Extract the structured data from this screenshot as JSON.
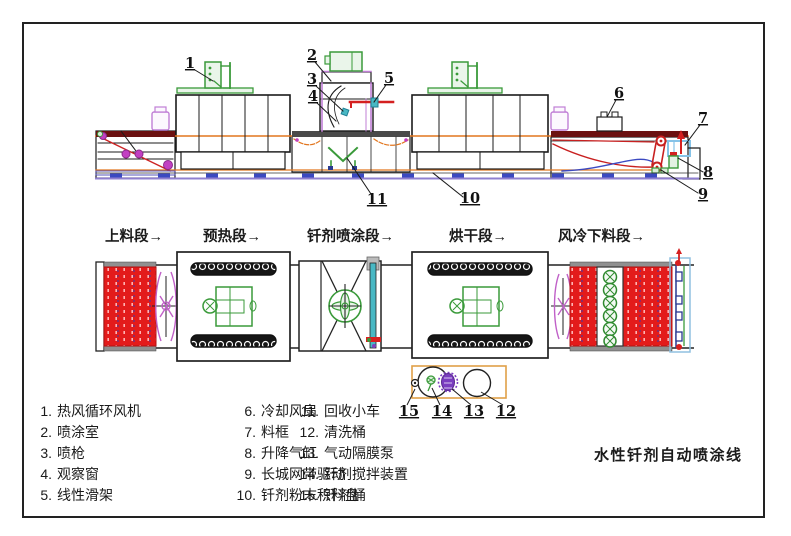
{
  "title": "水性钎剂自动喷涂线",
  "plan_sections": [
    "上料段→",
    "预热段→",
    "钎剂喷涂段→",
    "烘干段→",
    "风冷下料段→"
  ],
  "callout_numbers": [
    "1",
    "2",
    "3",
    "4",
    "5",
    "6",
    "7",
    "8",
    "9",
    "10",
    "11",
    "12",
    "13",
    "14",
    "15"
  ],
  "legend": {
    "columns": [
      {
        "items": [
          {
            "num": "1.",
            "label": "热风循环风机"
          },
          {
            "num": "2.",
            "label": "喷涂室"
          },
          {
            "num": "3.",
            "label": "喷枪"
          },
          {
            "num": "4.",
            "label": "观察窗"
          },
          {
            "num": "5.",
            "label": "线性滑架"
          }
        ]
      },
      {
        "items": [
          {
            "num": "6.",
            "label": "冷却风扇"
          },
          {
            "num": "7.",
            "label": "料框"
          },
          {
            "num": "8.",
            "label": "升降气缸"
          },
          {
            "num": "9.",
            "label": "长城网带驱动"
          },
          {
            "num": "10.",
            "label": "钎剂粉末积料盘"
          }
        ]
      },
      {
        "items": [
          {
            "num": "11.",
            "label": "回收小车"
          },
          {
            "num": "12.",
            "label": "清洗桶"
          },
          {
            "num": "13.",
            "label": "气动隔膜泵"
          },
          {
            "num": "14.",
            "label": "钎剂搅拌装置"
          },
          {
            "num": "15.",
            "label": "钎剂桶"
          }
        ]
      }
    ]
  },
  "palette": {
    "belt_red": "#e31b1b",
    "machine_green": "#3a9a3a",
    "roller_magenta": "#c23fc2",
    "rail_blue": "#3b49c1",
    "conveyor_orange": "#e2761f",
    "slide_cyan": "#49b8c4",
    "top_bar_maroon": "#6b1111",
    "station_box_orange": "#e0a048",
    "frame_light_blue": "#85c3e8",
    "pump_purple": "#7a3cc0",
    "jar_purple": "#c07fd6"
  }
}
